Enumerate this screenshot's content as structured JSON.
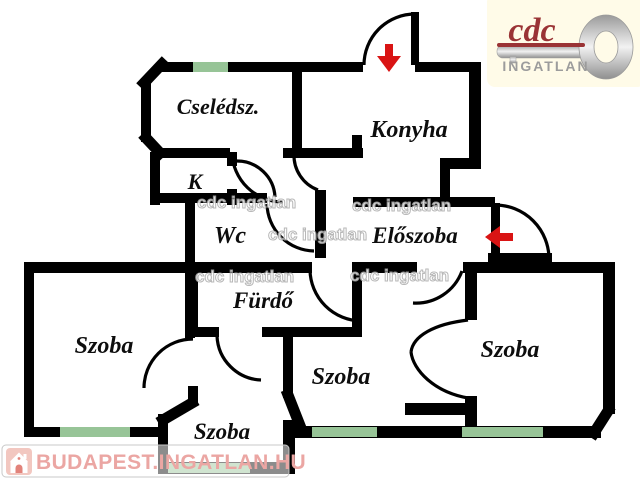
{
  "logo": {
    "brand": "cdc",
    "subtitle": "INGATLAN",
    "brand_color": "#9a3335",
    "background_color": "#fffbe8",
    "key_icon_color": "#c0c0c0"
  },
  "watermark": {
    "text": "cdc ingatlan"
  },
  "footer": {
    "site": "BUDAPEST.INGATLAN.HU",
    "text_color": "#eba6a3",
    "house_icon_bg": "#f2c7c0"
  },
  "floorplan": {
    "wall_color": "#000000",
    "window_color": "#97c497",
    "arrow_color": "#d91414",
    "rooms": [
      {
        "name": "Cselédsz."
      },
      {
        "name": "Konyha"
      },
      {
        "name": "K"
      },
      {
        "name": "Wc"
      },
      {
        "name": "Előszoba"
      },
      {
        "name": "Fürdő"
      },
      {
        "name": "Szoba",
        "position": "left"
      },
      {
        "name": "Szoba",
        "position": "center"
      },
      {
        "name": "Szoba",
        "position": "right"
      },
      {
        "name": "Szoba",
        "position": "bottom"
      }
    ]
  }
}
